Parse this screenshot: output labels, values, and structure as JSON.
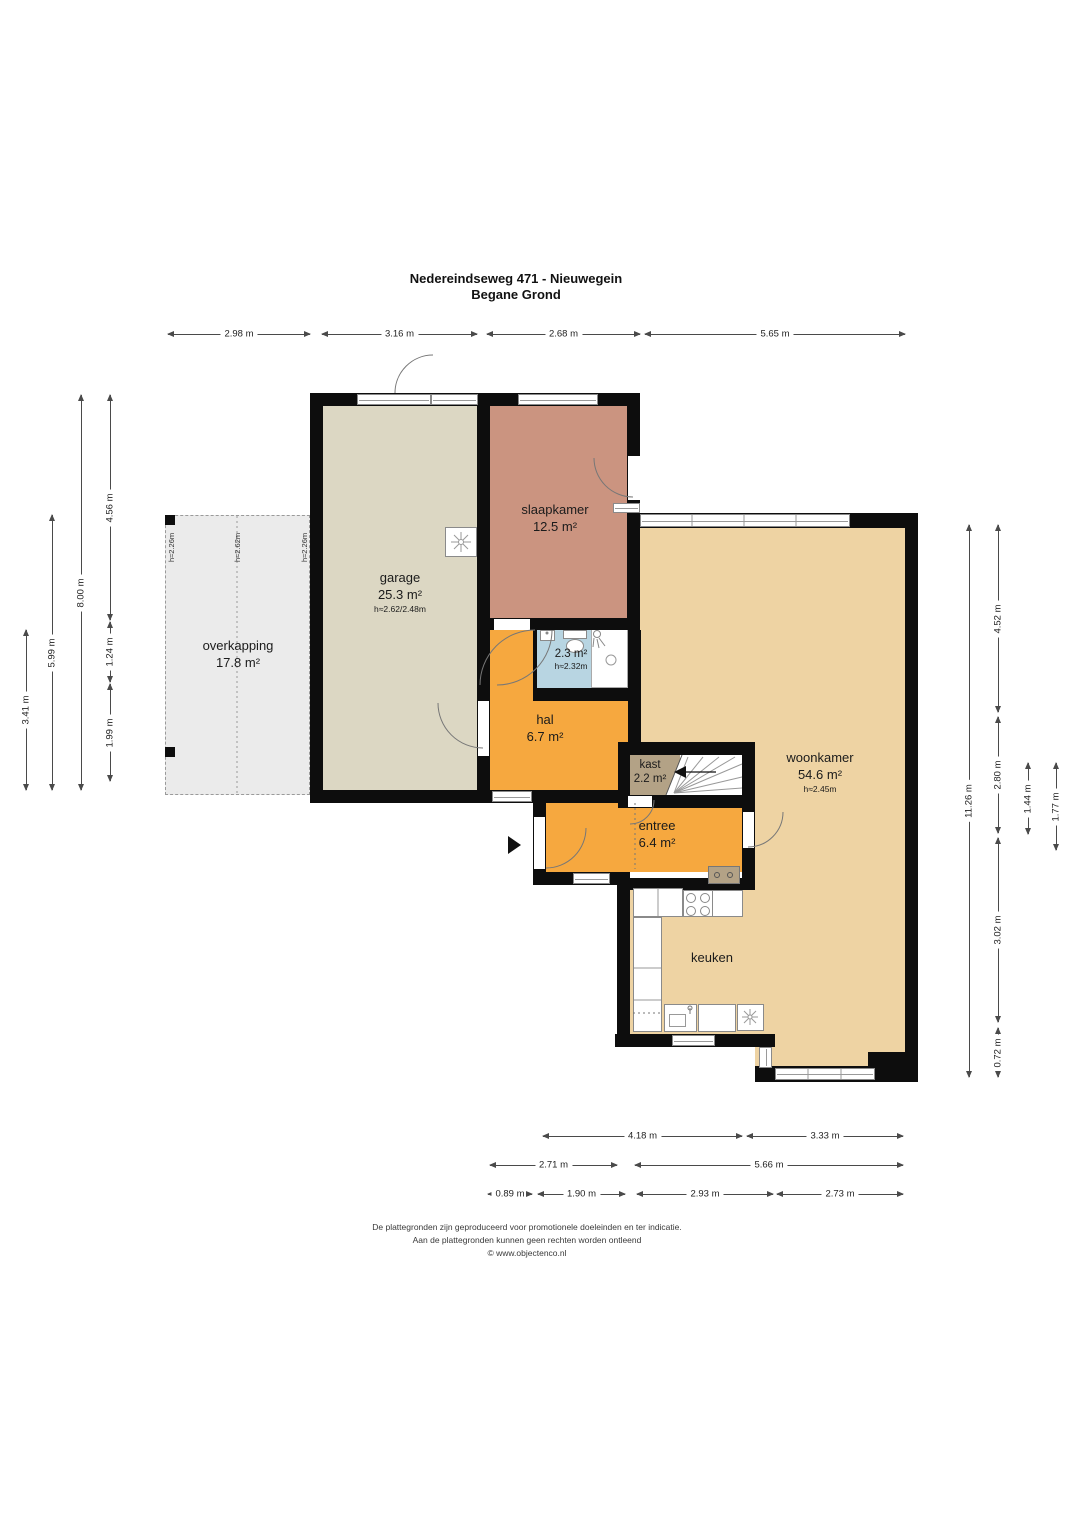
{
  "title": {
    "line1": "Nedereindseweg 471 - Nieuwegein",
    "line2": "Begane Grond"
  },
  "rooms": {
    "overkapping": {
      "name": "overkapping",
      "area": "17.8 m²"
    },
    "garage": {
      "name": "garage",
      "area": "25.3 m²",
      "ceiling": "h≈2.62/2.48m"
    },
    "slaapkamer": {
      "name": "slaapkamer",
      "area": "12.5 m²"
    },
    "badkamer": {
      "area": "2.3 m²",
      "ceiling": "h≈2.32m"
    },
    "hal": {
      "name": "hal",
      "area": "6.7 m²"
    },
    "kast": {
      "name": "kast",
      "area": "2.2 m²"
    },
    "entree": {
      "name": "entree",
      "area": "6.4 m²"
    },
    "woonkamer": {
      "name": "woonkamer",
      "area": "54.6 m²",
      "ceiling": "h≈2.45m"
    },
    "keuken": {
      "name": "keuken"
    }
  },
  "overkapping_heights": [
    "h≈2.26m",
    "h≈2.62m",
    "h≈2.26m"
  ],
  "dims": {
    "top": [
      "2.98 m",
      "3.16 m",
      "2.68 m",
      "5.65 m"
    ],
    "left": [
      "3.41 m",
      "5.99 m",
      "8.00 m",
      "4.56 m",
      "1.24 m",
      "1.99 m"
    ],
    "right": [
      "11.26 m",
      "4.52 m",
      "2.80 m",
      "3.02 m",
      "0.72 m",
      "1.44 m",
      "1.77 m"
    ],
    "bottom1": [
      "4.18 m",
      "3.33 m"
    ],
    "bottom2": [
      "2.71 m",
      "5.66 m"
    ],
    "bottom3": [
      "0.89 m",
      "1.90 m",
      "2.93 m",
      "2.73 m"
    ]
  },
  "footer": {
    "line1": "De plattegronden zijn geproduceerd voor promotionele doeleinden en ter indicatie.",
    "line2": "Aan de plattegronden kunnen geen rechten worden ontleend",
    "line3": "© www.objectenco.nl"
  },
  "colors": {
    "wall": "#0d0d0d",
    "overkapping": "#ebebeb",
    "garage": "#dcd7c3",
    "slaapkamer": "#cb9480",
    "badkamer": "#b8d5e2",
    "hal": "#f6a83f",
    "kast": "#b3a286",
    "woonkamer": "#eed3a3",
    "door_arc": "#777777"
  }
}
